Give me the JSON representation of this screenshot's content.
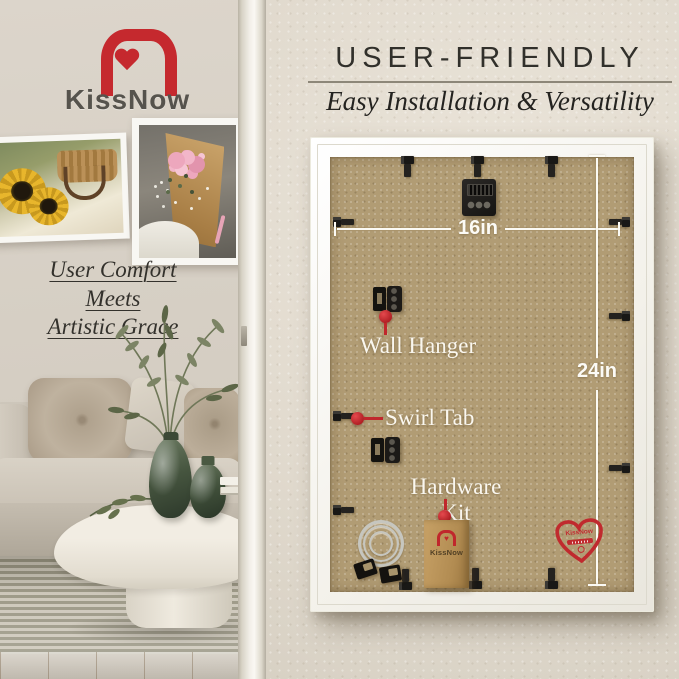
{
  "brand": {
    "name": "KissNow"
  },
  "left_scene": {
    "tagline": [
      "User Comfort",
      "Meets",
      "Artistic Grace"
    ],
    "artworks": [
      "sunflower-picnic-photo",
      "pink-bouquet-photo"
    ]
  },
  "right_panel": {
    "title": "USER-FRIENDLY",
    "subtitle": "Easy Installation & Versatility",
    "dimensions": {
      "width": "16in",
      "height": "24in"
    },
    "callouts": {
      "wall_hanger": "Wall Hanger",
      "swirl_tab": "Swirl Tab",
      "hardware_kit": "Hardware Kit"
    },
    "bag_brand": "KissNow",
    "badge_brand": "KissNow"
  },
  "icons": {
    "heart_glyph": "♥"
  },
  "colors": {
    "accent_red": "#c0272c",
    "kraft_backing": "#b19c74",
    "frame_white": "#f5f3ee",
    "wall_beige": "#e2dbcf",
    "room_wall": "#d5cec3"
  }
}
